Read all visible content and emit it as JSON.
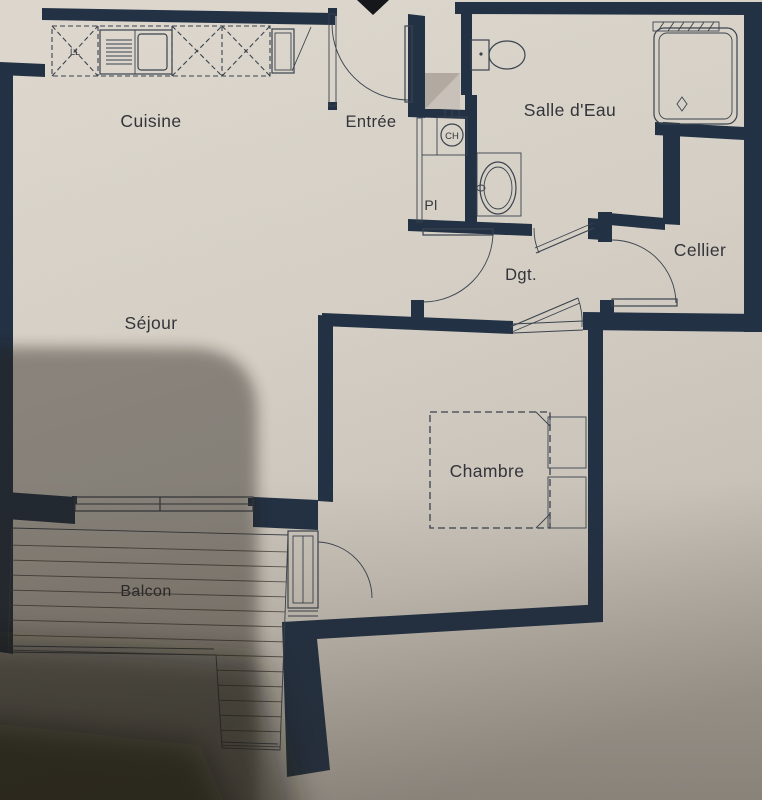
{
  "rooms": {
    "cuisine": {
      "label": "Cuisine"
    },
    "entree": {
      "label": "Entrée"
    },
    "salle_eau": {
      "label": "Salle d'Eau"
    },
    "cellier": {
      "label": "Cellier"
    },
    "dgt": {
      "label": "Dgt."
    },
    "sejour": {
      "label": "Séjour"
    },
    "chambre": {
      "label": "Chambre"
    },
    "balcon": {
      "label": "Balcon"
    }
  },
  "annotations": {
    "placard": "Pl",
    "water_heater": "CH",
    "washing_machine": "LL"
  },
  "colors": {
    "wall": "#223144",
    "paper": "#d8d2c8",
    "line": "#3a434e",
    "text": "#33343a",
    "shadow": "#231b15"
  }
}
